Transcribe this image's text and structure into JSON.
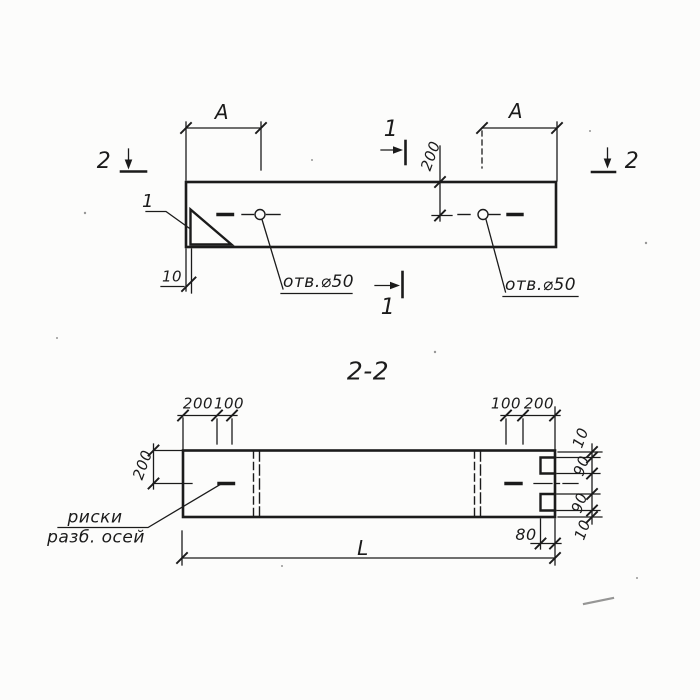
{
  "drawing": {
    "kind": "technical section drawing",
    "colors": {
      "ink": "#1b1b1b",
      "paper": "#fcfcfb"
    }
  },
  "top_view": {
    "dim_a_left": "A",
    "dim_a_right": "A",
    "dim_200": "200",
    "dim_10": "10",
    "callout": "1",
    "hole_label_left": "отв.⌀50",
    "hole_label_right": "отв.⌀50",
    "section_1_top": "1",
    "section_1_bottom": "1",
    "section_2_left": "2",
    "section_2_right": "2"
  },
  "section_view": {
    "title": "2-2",
    "dim_left_chain": [
      "200",
      "100"
    ],
    "dim_right_chain": [
      "100",
      "200"
    ],
    "dim_height": "200",
    "dim_right_side": [
      "10",
      "90",
      "90",
      "10"
    ],
    "dim_80": "80",
    "dim_length": "L",
    "leader_line1": "риски",
    "leader_line2": "разб. осей"
  }
}
